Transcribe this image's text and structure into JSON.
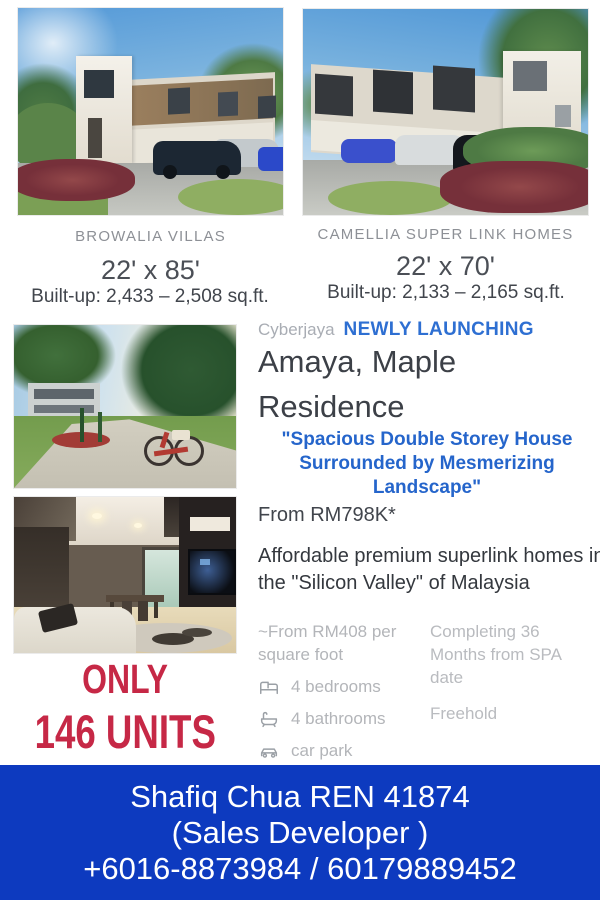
{
  "colors": {
    "accent_blue": "#2e6fd2",
    "quote_blue": "#2565cb",
    "footer_blue": "#0d3abf",
    "units_red": "#c62846",
    "muted_gray": "#b3b5b9",
    "dark_text": "#3c4047"
  },
  "top": {
    "left": {
      "caption": "BROWALIA VILLAS",
      "dimensions": "22' x 85'",
      "builtup": "Built-up: 2,433 – 2,508 sq.ft."
    },
    "right": {
      "caption": "CAMELLIA SUPER LINK HOMES",
      "dimensions": "22' x 70'",
      "builtup": "Built-up: 2,133 – 2,165 sq.ft."
    }
  },
  "middle": {
    "location": "Cyberjaya",
    "launch_tag": "NEWLY LAUNCHING",
    "title_line1": "Amaya, Maple",
    "title_line2": "Residence",
    "quote": "\"Spacious Double Storey House Surrounded by Mesmerizing Landscape\"",
    "price": "From RM798K*",
    "description": "Affordable premium superlink homes in the \"Silicon Valley\" of Malaysia",
    "psf": "~From RM408 per square foot",
    "features": [
      {
        "icon": "bed-icon",
        "label": "4 bedrooms"
      },
      {
        "icon": "bath-icon",
        "label": "4 bathrooms"
      },
      {
        "icon": "car-icon",
        "label": "car park"
      }
    ],
    "completion": "Completing 36 Months from SPA date",
    "tenure": "Freehold",
    "units_line1": "ONLY",
    "units_line2": "146 UNITS"
  },
  "footer": {
    "line1": "Shafiq Chua REN 41874",
    "line2": "(Sales Developer )",
    "line3": "+6016-8873984 / 60179889452"
  }
}
